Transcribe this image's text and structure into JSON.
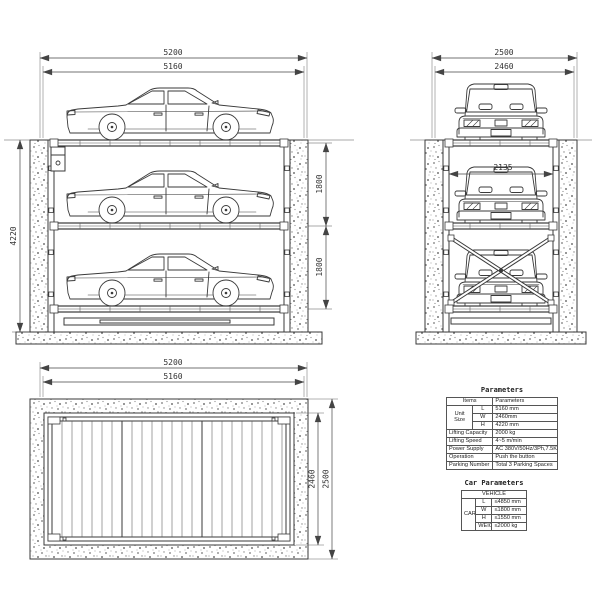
{
  "drawing": {
    "side_view": {
      "dim_width_outer": "5200",
      "dim_width_inner": "5160",
      "dim_pit_depth": "4220",
      "dim_level_upper": "1800",
      "dim_level_lower": "1800"
    },
    "front_view": {
      "dim_width_outer": "2500",
      "dim_width_inner": "2460",
      "dim_platform_width": "2135"
    },
    "plan_view": {
      "dim_length_outer": "5200",
      "dim_length_inner": "5160",
      "dim_width_inner": "2460",
      "dim_width_outer": "2500"
    }
  },
  "parameters_table": {
    "title": "Parameters",
    "col_items": "Items",
    "col_parameters": "Parameters",
    "unit_size_label": "Unit Size",
    "unit_rows": [
      {
        "label": "L",
        "value": "5160 mm"
      },
      {
        "label": "W",
        "value": "2460mm"
      },
      {
        "label": "H",
        "value": "4220 mm"
      }
    ],
    "rows": [
      {
        "label": "Lifting Capacity",
        "value": "2000 kg"
      },
      {
        "label": "Lifting Speed",
        "value": "4~5 m/min"
      },
      {
        "label": "Power Supply",
        "value": "AC 380V/50Hz/3Ph,7.5Kw"
      },
      {
        "label": "Operation",
        "value": "Push the button"
      },
      {
        "label": "Parking Number",
        "value": "Total 3 Parking Spaces"
      }
    ]
  },
  "car_table": {
    "title": "Car Parameters",
    "header": "VEHICLE",
    "group_label": "CAR",
    "rows": [
      {
        "label": "L",
        "value": "≤4850 mm"
      },
      {
        "label": "W",
        "value": "≤1800 mm"
      },
      {
        "label": "H",
        "value": "≤1550 mm"
      },
      {
        "label": "WEIGHT",
        "value": "≤2000 kg"
      }
    ]
  },
  "colors": {
    "line": "#3a3a3a",
    "background": "#ffffff"
  }
}
